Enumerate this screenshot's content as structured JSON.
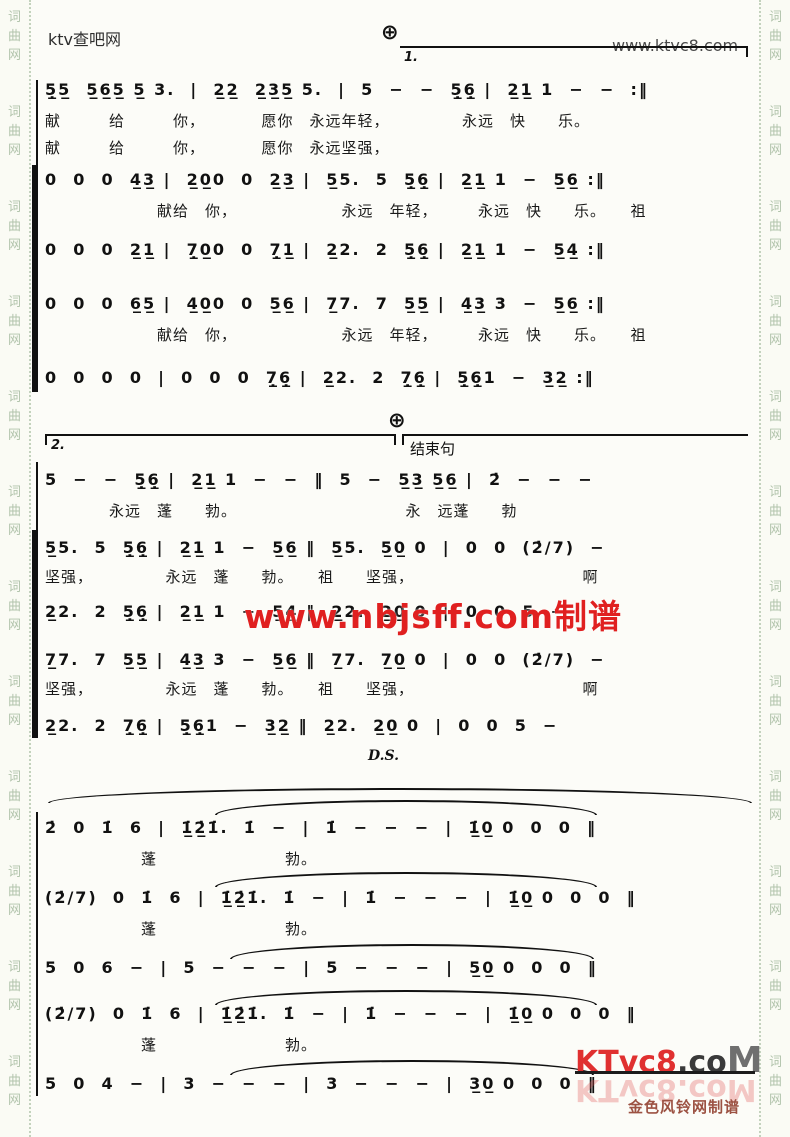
{
  "header": {
    "site_left": "ktv查吧网",
    "site_right": "www.ktvc8.com"
  },
  "border": {
    "column_text": "词\n曲\n网\n\n\n词\n曲\n网\n\n\n词\n曲\n网\n\n\n词\n曲\n网\n\n\n词\n曲\n网\n\n\n词\n曲\n网\n\n\n词\n曲\n网\n\n\n词\n曲\n网\n\n\n词\n曲\n网\n\n\n词\n曲\n网\n\n\n词\n曲\n网\n\n\n词\n曲\n网"
  },
  "marks": {
    "coda": "⊕",
    "volta1": "1.",
    "volta2": "2.",
    "ending_label": "结束句",
    "ds": "D.S."
  },
  "watermarks": {
    "center": "www.nbjsff.com制谱",
    "logo_red": "KTvc8",
    "logo_dot_co": ".co",
    "logo_m": "M",
    "logo_reflection": "KTvc8.coM",
    "credit": "金色风铃网制谱"
  },
  "score": {
    "system1": {
      "lines": [
        {
          "notes": "5̣̲5̲  5̲6̲5̲ 5̲ 3.  |  2̲2̲  2̲3̲5̲ 5.  |  5  −  −  5̣̲6̣̲ |  2̲1̲ 1  −  −  :‖",
          "lyrics1": "献　　　给　　　你，　　　　愿你　永远年轻，　　　　　永远　快　　乐。",
          "lyrics2": "献　　　给　　　你，　　　　愿你　永远坚强，"
        },
        {
          "notes": "0  0  0  4̲3̲ |  2̲0̲0  0  2̲3̲ |  5̲5.  5  5̣̲6̣̲ |  2̲1̲ 1  −  5̲6̲ :‖",
          "lyrics1": "　　　　　　　献给　你，　　　　　　　永远　年轻，　　　永远　快　　乐。　　祖"
        },
        {
          "notes": "0  0  0  2̲1̲ |  7̣̲0̲0  0  7̣̲1̲ |  2̲2.  2  5̣̲6̣̲ |  2̲1̲ 1  −  5̲4̲ :‖"
        },
        {
          "notes": "0  0  0  6̲5̲ |  4̲0̲0  0  5̲6̲ |  7̲7.  7  5̲5̲ |  4̲3̲ 3  −  5̲6̲ :‖",
          "lyrics1": "　　　　　　　献给　你，　　　　　　　永远　年轻，　　　永远　快　　乐。　　祖"
        },
        {
          "notes": "0  0  0  0  |  0  0  0  7̣̲6̣̲ |  2̲2.  2  7̣̲6̣̲ |  5̣̲6̣̲1  −  3̲2̲ :‖"
        }
      ]
    },
    "system2": {
      "lines": [
        {
          "notes": "5  −  −  5̣̲6̣̲ |  2̲1̲ 1  −  −  ‖  5  −  5̲3̲ 5̲6̲ |  2̇  −  −  −",
          "lyrics1": "　　　　永远　蓬　　勃。　　　　　　　　　　　永　远蓬　　勃"
        },
        {
          "notes": "5̲5.  5  5̣̲6̣̲ |  2̲1̲ 1  −  5̲6̲ ‖  5̲5.  5̲0̲ 0  |  0  0  (2̇/7)  −",
          "lyrics1": "坚强，　　　　　永远　蓬　　勃。　　祖　　坚强，　　　　　　　　　　　啊"
        },
        {
          "notes": "2̲2.  2  5̣̲6̣̲ |  2̲1̲ 1  −  5̲4̲ ‖  2̲2.  2̲0̲ 0  |  0  0  5  −"
        },
        {
          "notes": "7̲7.  7  5̲5̲ |  4̲3̲ 3  −  5̲6̲ ‖  7̲7.  7̲0̲ 0  |  0  0  (2̇/7)  −",
          "lyrics1": "坚强，　　　　　永远　蓬　　勃。　　祖　　坚强，　　　　　　　　　　　啊"
        },
        {
          "notes": "2̲2.  2  7̣̲6̣̲ |  5̣̲6̣̲1  −  3̲2̲ ‖  2̲2.  2̲0̲ 0  |  0  0  5  −"
        }
      ]
    },
    "system3": {
      "lines": [
        {
          "notes": "2̇  0  1̇  6  |  1̲̇2̲̇1̇.  1̇  −  |  1̇  −  −  −  |  1̲̇0̲ 0  0  0  ‖",
          "lyrics1": "　　　　　　蓬　　　　　　　　勃。"
        },
        {
          "notes": "(2̇/7)  0  1̇  6  |  1̲̇2̲̇1̇.  1̇  −  |  1̇  −  −  −  |  1̲̇0̲ 0  0  0  ‖",
          "lyrics1": "　　　　　　蓬　　　　　　　　勃。"
        },
        {
          "notes": "5  0  6  −  |  5  −  −  −  |  5  −  −  −  |  5̲0̲ 0  0  0  ‖"
        },
        {
          "notes": "(2̇/7)  0  1̇  6  |  1̲̇2̲̇1̇.  1̇  −  |  1̇  −  −  −  |  1̲̇0̲ 0  0  0  ‖",
          "lyrics1": "　　　　　　蓬　　　　　　　　勃。"
        },
        {
          "notes": "5  0  4  −  |  3  −  −  −  |  3  −  −  −  |  3̲0̲ 0  0  0  ‖"
        }
      ]
    }
  }
}
